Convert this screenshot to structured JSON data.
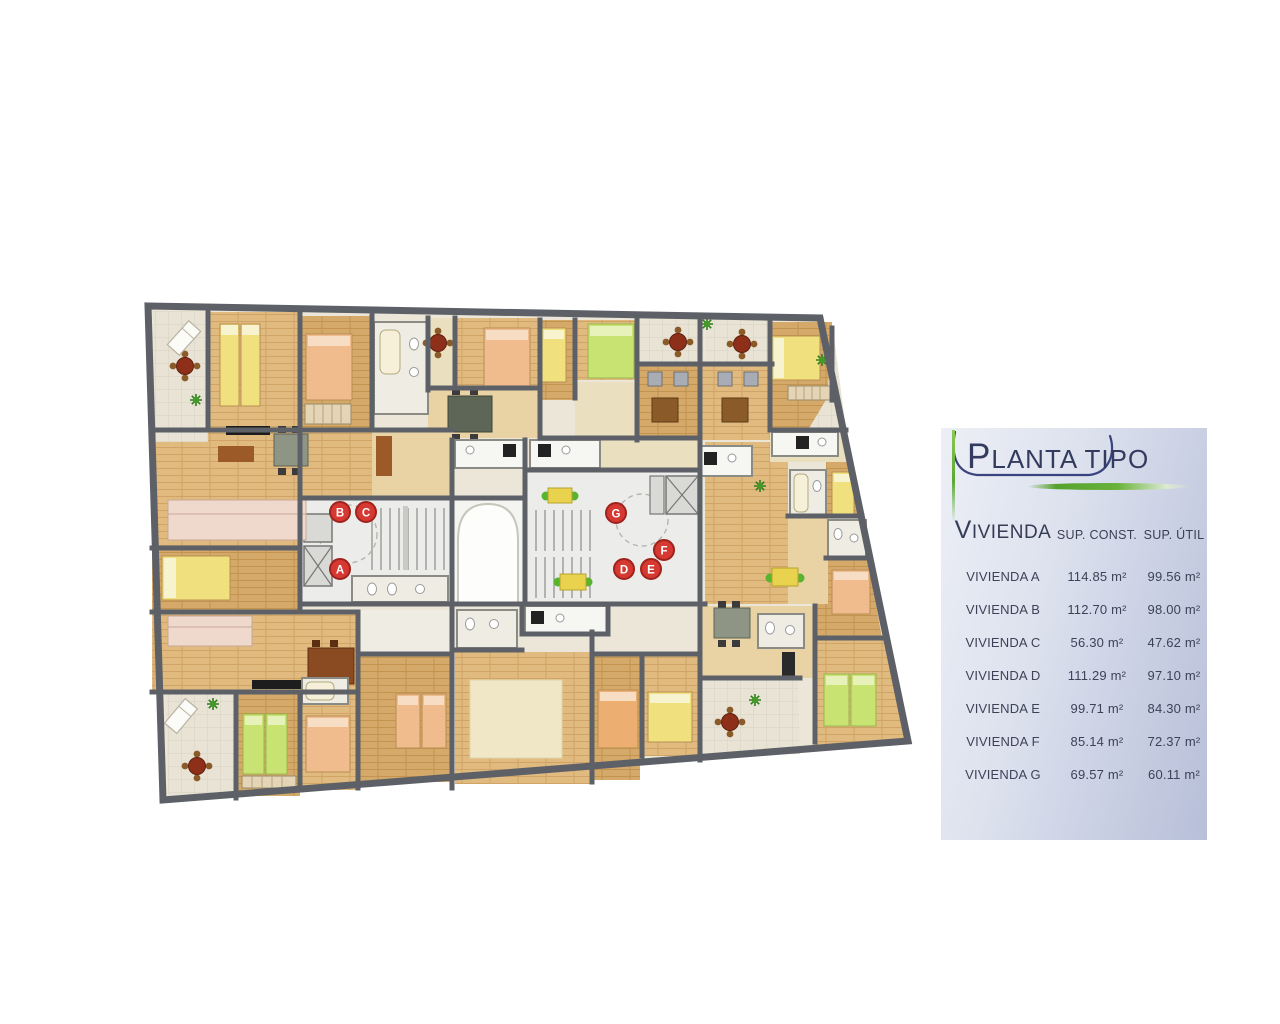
{
  "title_panel": {
    "title": "PLANTA TIPO",
    "table": {
      "col_name": "VIVIENDA",
      "col_const": "SUP. CONST.",
      "col_util": "SUP. ÚTIL",
      "rows": [
        {
          "name": "VIVIENDA A",
          "const": "114.85 m²",
          "util": "99.56 m²"
        },
        {
          "name": "VIVIENDA B",
          "const": "112.70 m²",
          "util": "98.00 m²"
        },
        {
          "name": "VIVIENDA C",
          "const": "56.30 m²",
          "util": "47.62 m²"
        },
        {
          "name": "VIVIENDA D",
          "const": "111.29 m²",
          "util": "97.10 m²"
        },
        {
          "name": "VIVIENDA E",
          "const": "99.71 m²",
          "util": "84.30 m²"
        },
        {
          "name": "VIVIENDA F",
          "const": "85.14 m²",
          "util": "72.37 m²"
        },
        {
          "name": "VIVIENDA G",
          "const": "69.57 m²",
          "util": "60.11 m²"
        }
      ]
    }
  },
  "plan": {
    "units": [
      {
        "label": "A"
      },
      {
        "label": "B"
      },
      {
        "label": "C"
      },
      {
        "label": "D"
      },
      {
        "label": "E"
      },
      {
        "label": "F"
      },
      {
        "label": "G"
      }
    ]
  },
  "colors": {
    "badge_red": "#d63832",
    "wall_gray": "#5d6167",
    "navy": "#333b5e",
    "accent_green": "#5aa832"
  }
}
